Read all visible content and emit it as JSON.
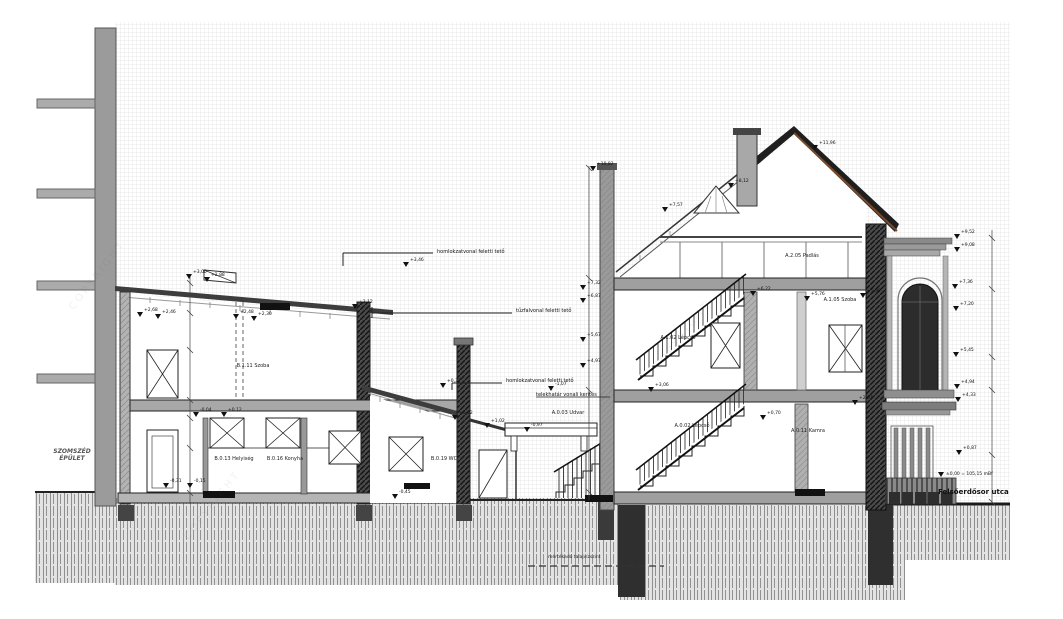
{
  "labels": {
    "neighbor_line1": "SZOMSZÉD",
    "neighbor_line2": "ÉPÜLET",
    "street": "Felsőerdősor utca",
    "datum": "±0,00 = 105,15 mBf",
    "groundwater": "mértékadó talajvízszint",
    "watermark": "COPYRIGHT"
  },
  "room_labels": [
    {
      "x": 253,
      "y": 363,
      "t": "B.1.11 Szoba"
    },
    {
      "x": 234,
      "y": 456,
      "t": "B.0.13 Helyiség"
    },
    {
      "x": 285,
      "y": 456,
      "t": "B.0.16 Konyha"
    },
    {
      "x": 444,
      "y": 456,
      "t": "B.0.19 WC"
    },
    {
      "x": 568,
      "y": 410,
      "t": "A.0.03 Udvar"
    },
    {
      "x": 802,
      "y": 253,
      "t": "A.2.05 Padlás"
    },
    {
      "x": 678,
      "y": 335,
      "t": "A.1.02 Lépcső"
    },
    {
      "x": 840,
      "y": 297,
      "t": "A.1.05 Szoba"
    },
    {
      "x": 692,
      "y": 423,
      "t": "A.0.02 Lépcső"
    },
    {
      "x": 808,
      "y": 428,
      "t": "A.0.11 Kamra"
    }
  ],
  "annotations": [
    {
      "x": 437,
      "y": 249,
      "t": "homlokzatvonal feletti tető"
    },
    {
      "x": 516,
      "y": 308,
      "t": "tűzfalvonal feletti tető"
    },
    {
      "x": 506,
      "y": 378,
      "t": "homlokzatvonal feletti tető"
    },
    {
      "x": 536,
      "y": 392,
      "t": "telekhatár vonali kerítés"
    }
  ],
  "level_markers": [
    {
      "x": 186,
      "y": 274,
      "v": "+3,00"
    },
    {
      "x": 204,
      "y": 277,
      "v": "+2,88"
    },
    {
      "x": 137,
      "y": 312,
      "v": "+2,68"
    },
    {
      "x": 155,
      "y": 314,
      "v": "+2,46"
    },
    {
      "x": 233,
      "y": 314,
      "v": "+2,48"
    },
    {
      "x": 251,
      "y": 316,
      "v": "+2,30"
    },
    {
      "x": 352,
      "y": 304,
      "v": "+2,12"
    },
    {
      "x": 193,
      "y": 412,
      "v": "-0,04"
    },
    {
      "x": 221,
      "y": 412,
      "v": "+0,12"
    },
    {
      "x": 163,
      "y": 483,
      "v": "-0,31"
    },
    {
      "x": 187,
      "y": 483,
      "v": "-0,15"
    },
    {
      "x": 403,
      "y": 262,
      "v": "+3,46"
    },
    {
      "x": 440,
      "y": 383,
      "v": "+0,37"
    },
    {
      "x": 452,
      "y": 415,
      "v": "+0,02"
    },
    {
      "x": 484,
      "y": 423,
      "v": "+1,02"
    },
    {
      "x": 392,
      "y": 494,
      "v": "-0,45"
    },
    {
      "x": 548,
      "y": 386,
      "v": "-1,07"
    },
    {
      "x": 524,
      "y": 427,
      "v": "-0,97"
    },
    {
      "x": 580,
      "y": 285,
      "v": "+7,32"
    },
    {
      "x": 580,
      "y": 298,
      "v": "+6,87"
    },
    {
      "x": 580,
      "y": 337,
      "v": "+5,67"
    },
    {
      "x": 580,
      "y": 363,
      "v": "+4,97"
    },
    {
      "x": 590,
      "y": 166,
      "v": "+10,82"
    },
    {
      "x": 662,
      "y": 207,
      "v": "+7,57"
    },
    {
      "x": 728,
      "y": 183,
      "v": "+8,12"
    },
    {
      "x": 812,
      "y": 145,
      "v": "+11,96"
    },
    {
      "x": 750,
      "y": 291,
      "v": "+6,22"
    },
    {
      "x": 804,
      "y": 296,
      "v": "+5,76"
    },
    {
      "x": 860,
      "y": 293,
      "v": "+5,90"
    },
    {
      "x": 648,
      "y": 387,
      "v": "+3,06"
    },
    {
      "x": 760,
      "y": 415,
      "v": "+0,70"
    },
    {
      "x": 852,
      "y": 400,
      "v": "+2,87"
    },
    {
      "x": 954,
      "y": 234,
      "v": "+9,52"
    },
    {
      "x": 954,
      "y": 247,
      "v": "+9,08"
    },
    {
      "x": 952,
      "y": 284,
      "v": "+7,36"
    },
    {
      "x": 953,
      "y": 306,
      "v": "+7,20"
    },
    {
      "x": 953,
      "y": 352,
      "v": "+5,45"
    },
    {
      "x": 954,
      "y": 384,
      "v": "+4,94"
    },
    {
      "x": 955,
      "y": 397,
      "v": "+4,33"
    },
    {
      "x": 956,
      "y": 450,
      "v": "+0,87"
    }
  ],
  "colors": {
    "wall_gray": "#9b9b9b",
    "roof_dark": "#1f1f1f",
    "roof_brown": "#7a4a28",
    "hatch_dark": "#4a4a4a",
    "ground": "#e3e3e3"
  }
}
